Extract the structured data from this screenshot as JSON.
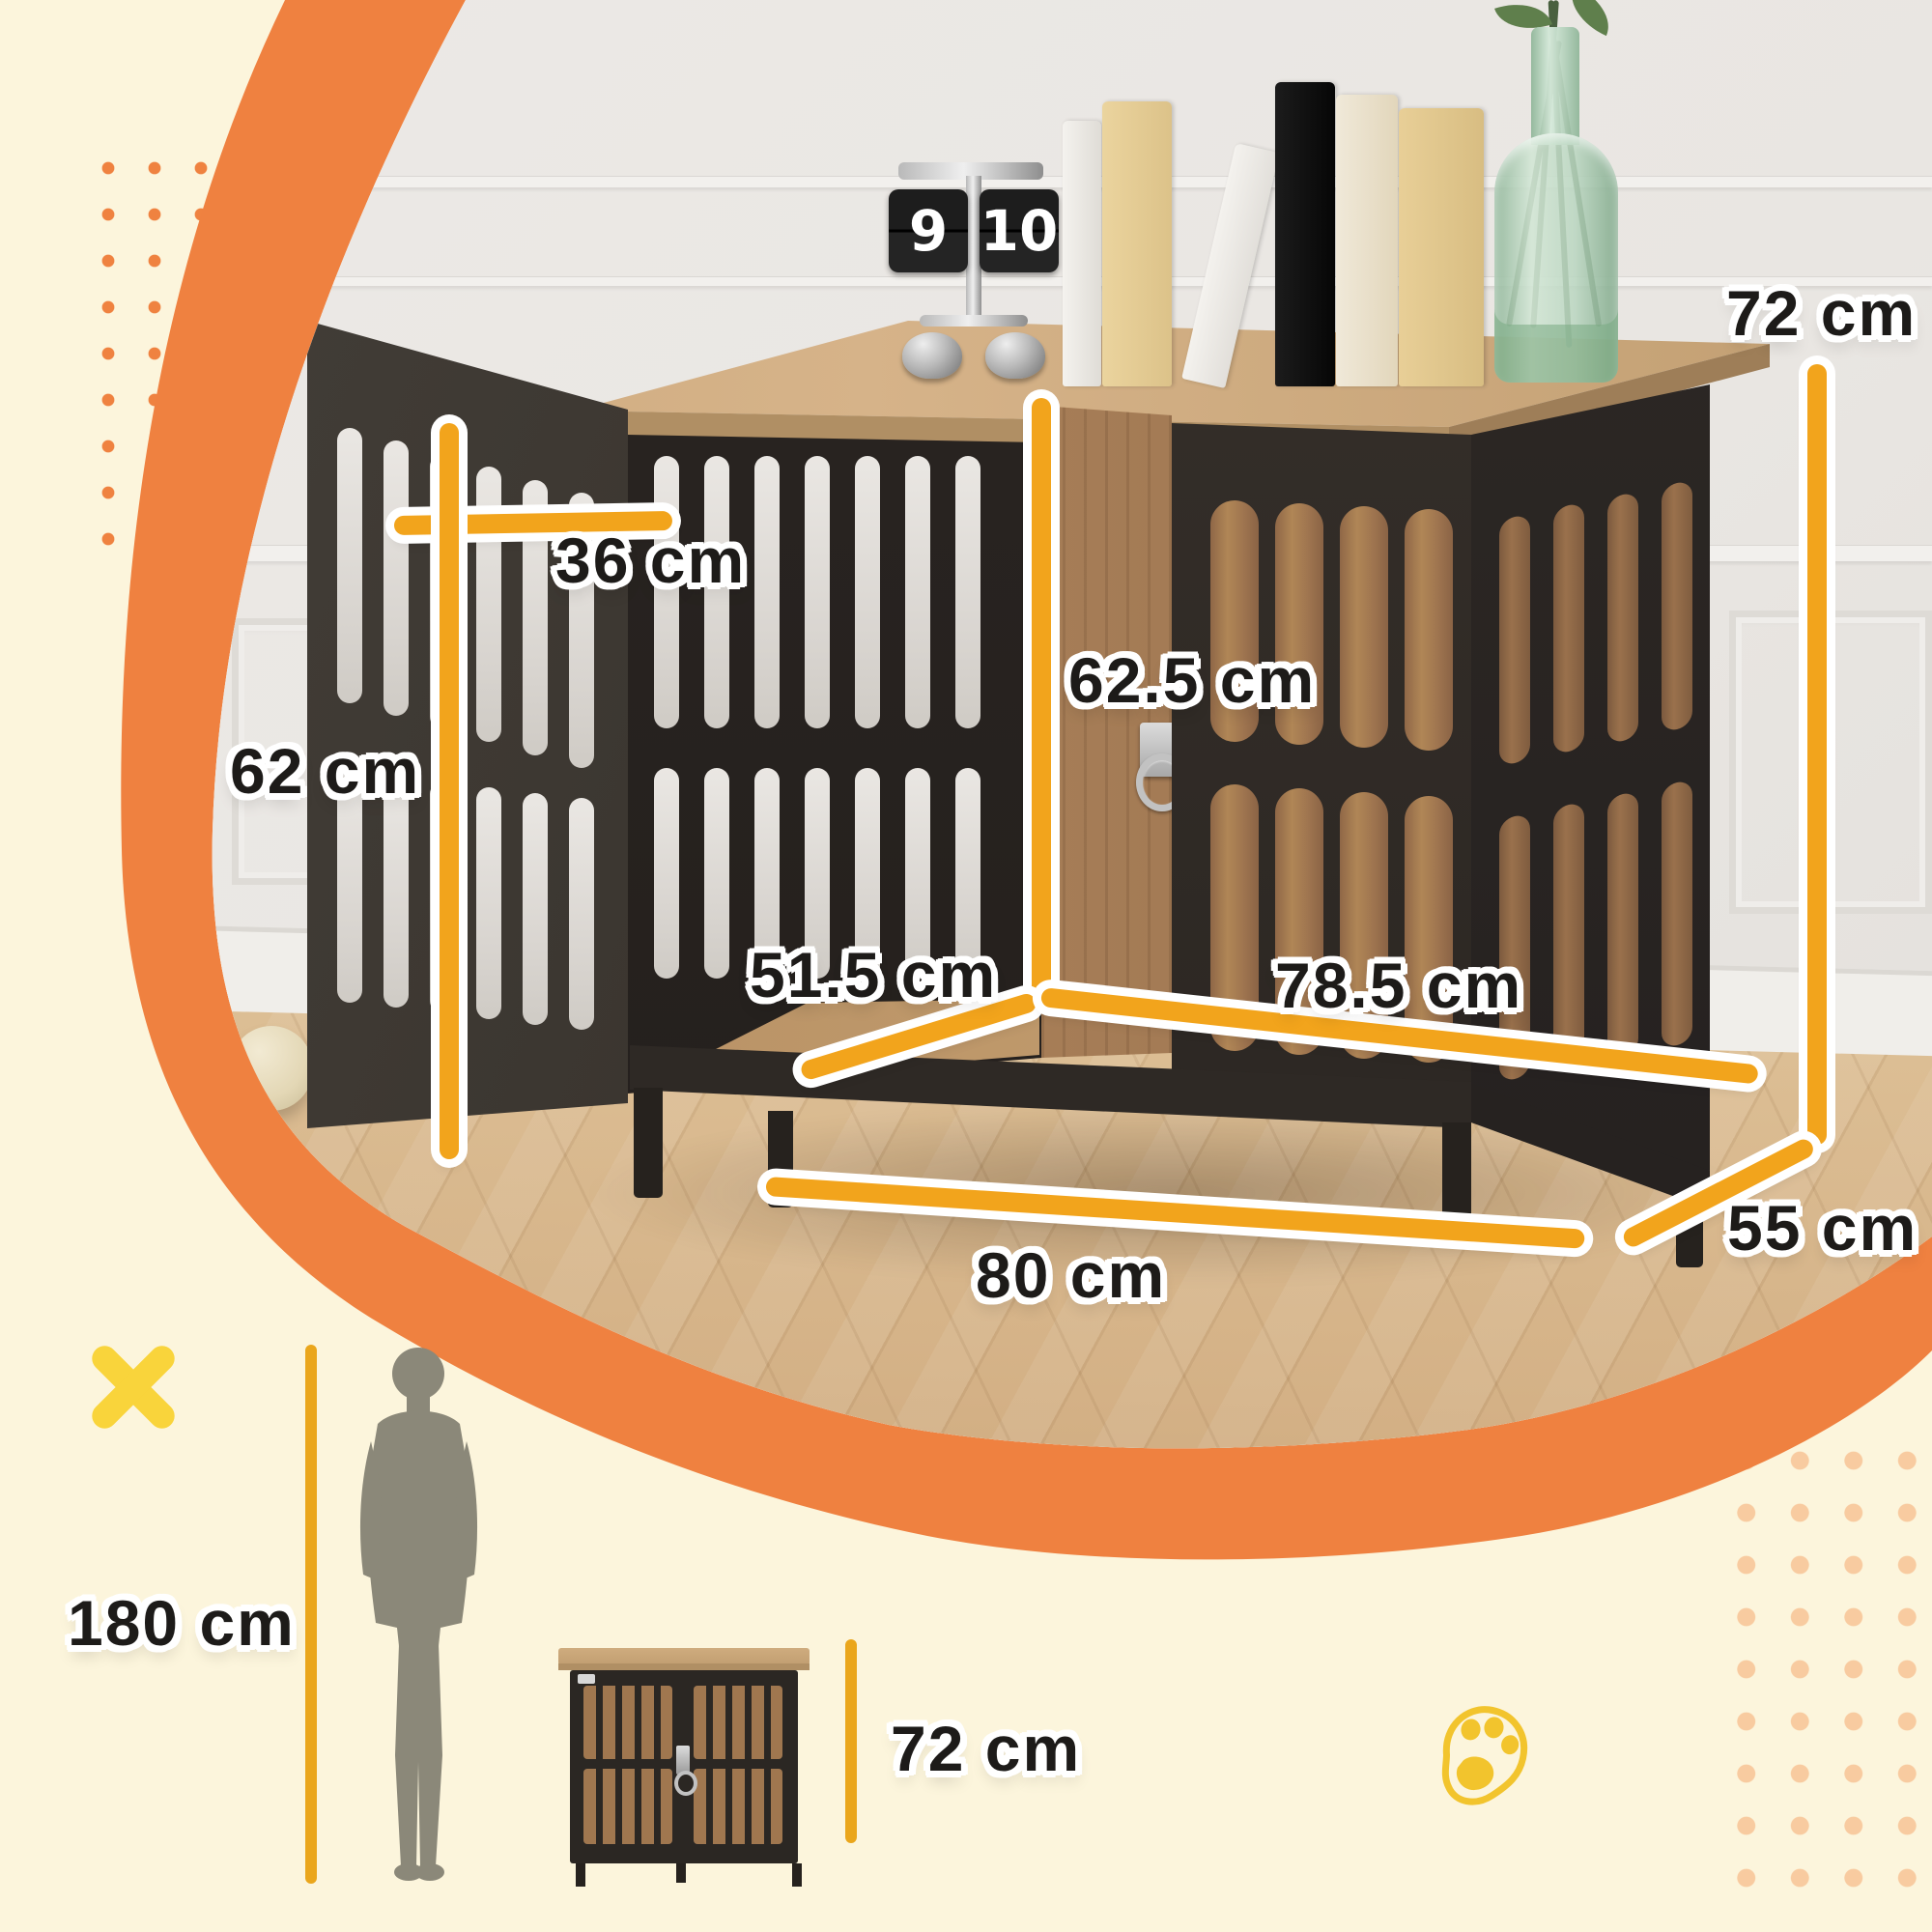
{
  "product_diagram": {
    "dimensions": {
      "overall_height": "72 cm",
      "front_door_width": "36 cm",
      "front_door_height": "62 cm",
      "interior_height": "62.5 cm",
      "interior_depth": "51.5 cm",
      "interior_width": "78.5 cm",
      "overall_width": "80 cm",
      "overall_depth": "55 cm"
    },
    "scale_comparison": {
      "person_height": "180 cm",
      "crate_height": "72 cm"
    },
    "flip_clock": {
      "hours": "9",
      "minutes": "10"
    },
    "colors": {
      "background": "#FCF5DC",
      "blob_orange": "#EF8140",
      "dimension_line_gold": "#F2A41C",
      "plain_line_gold": "#EAA61C",
      "label_text": "#1D1B19",
      "x_mark_yellow": "#F9D43B",
      "paw_yellow": "#F2C42D",
      "dots_left_orange": "#EF8240",
      "dots_right_peach": "#F8CBA0"
    }
  }
}
